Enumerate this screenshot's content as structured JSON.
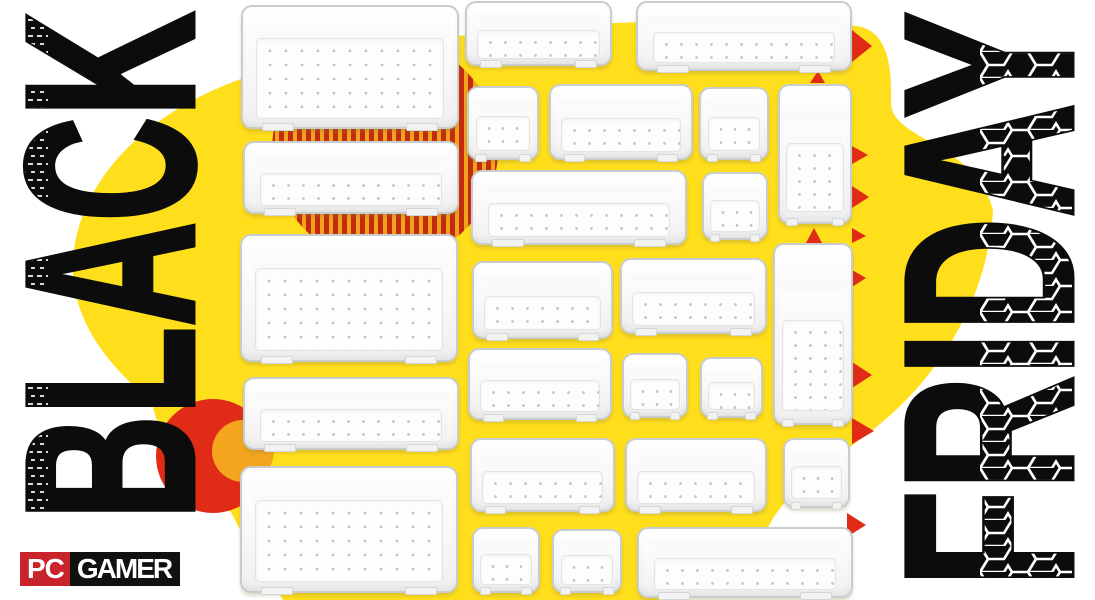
{
  "headline": {
    "left_word": "BLACK",
    "right_word": "FRIDAY"
  },
  "logo": {
    "pc": "PC",
    "gamer": "GAMER"
  },
  "colors": {
    "background": "#ffffff",
    "blob_yellow": "#FFDE1C",
    "circle_orange": "#F4A51D",
    "accent_red": "#E02B16",
    "stripe_red": "#C42B0D",
    "stripe_gap_orange": "#F1A31E",
    "logo_red": "#C9232B",
    "logo_black": "#111111",
    "ink": "#0C0C0C"
  },
  "products": {
    "type": "clear-plastic-drawer-organizer-trays",
    "count": 25,
    "trays": [
      [
        241,
        5,
        218,
        124,
        "big"
      ],
      [
        243,
        141,
        216,
        73,
        "wide"
      ],
      [
        240,
        234,
        218,
        128,
        "big"
      ],
      [
        243,
        377,
        216,
        73,
        "wide"
      ],
      [
        240,
        466,
        218,
        127,
        "big"
      ],
      [
        465,
        1,
        147,
        65,
        "wide"
      ],
      [
        636,
        1,
        216,
        70,
        "wide"
      ],
      [
        467,
        86,
        72,
        74,
        "square"
      ],
      [
        549,
        84,
        144,
        76,
        "wide"
      ],
      [
        699,
        87,
        70,
        73,
        "square"
      ],
      [
        778,
        84,
        74,
        140,
        "tall"
      ],
      [
        471,
        170,
        216,
        75,
        "wide"
      ],
      [
        702,
        172,
        66,
        68,
        "square"
      ],
      [
        472,
        261,
        141,
        78,
        "wide"
      ],
      [
        620,
        258,
        147,
        76,
        "wide"
      ],
      [
        773,
        243,
        80,
        182,
        "tall"
      ],
      [
        468,
        348,
        144,
        72,
        "wide"
      ],
      [
        622,
        353,
        66,
        65,
        "square"
      ],
      [
        700,
        357,
        63,
        61,
        "square"
      ],
      [
        470,
        438,
        145,
        74,
        "wide"
      ],
      [
        625,
        438,
        142,
        74,
        "wide"
      ],
      [
        783,
        438,
        67,
        70,
        "square"
      ],
      [
        472,
        527,
        68,
        66,
        "square"
      ],
      [
        552,
        529,
        70,
        64,
        "square"
      ],
      [
        637,
        527,
        216,
        71,
        "wide"
      ]
    ]
  },
  "decor": {
    "triangles": [
      "852,30 852,62 872,46",
      "810,83 825,83 818,71",
      "852,146 852,164 868,155",
      "852,186 852,208 869,197",
      "852,228 852,243 866,236",
      "806,243 822,243 814,228",
      "852,270 852,287 866,278",
      "852,362 852,388 872,375",
      "852,418 852,444 874,431",
      "847,513 847,537 866,525"
    ]
  }
}
